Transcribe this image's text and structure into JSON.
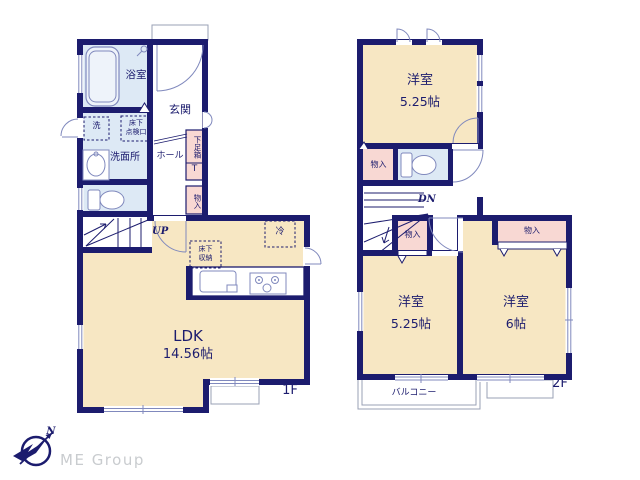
{
  "colors": {
    "wall": "#1c1c6e",
    "room_cream": "#f7e7c3",
    "wet_blue": "#dde9f5",
    "storage_pink": "#f8d8d3",
    "fixture_stroke": "#8089bd",
    "outline_gray": "#9aa0b5",
    "brand_gray": "#c9cccf"
  },
  "floor1": {
    "floor_label": "1F",
    "bathroom": "浴室",
    "entrance": "玄関",
    "washer": "洗",
    "hatch_l1": "床下",
    "hatch_l2": "点検口",
    "washroom": "洗面所",
    "hall": "ホール",
    "shoebox": "下足箱",
    "toilet_t": "T",
    "storage": "物入",
    "up": "UP",
    "fridge": "冷",
    "ufs_l1": "床下",
    "ufs_l2": "収納",
    "ldk": "LDK",
    "ldk_size": "14.56帖"
  },
  "floor2": {
    "floor_label": "2F",
    "room1": "洋室",
    "room1_size": "5.25帖",
    "storage1": "物入",
    "dn": "DN",
    "storage2": "物入",
    "room2": "洋室",
    "room2_size": "5.25帖",
    "room3": "洋室",
    "room3_size": "6帖",
    "storage3": "物入",
    "balcony": "バルコニー"
  },
  "compass": {
    "north": "N"
  },
  "brand": "ME Group"
}
